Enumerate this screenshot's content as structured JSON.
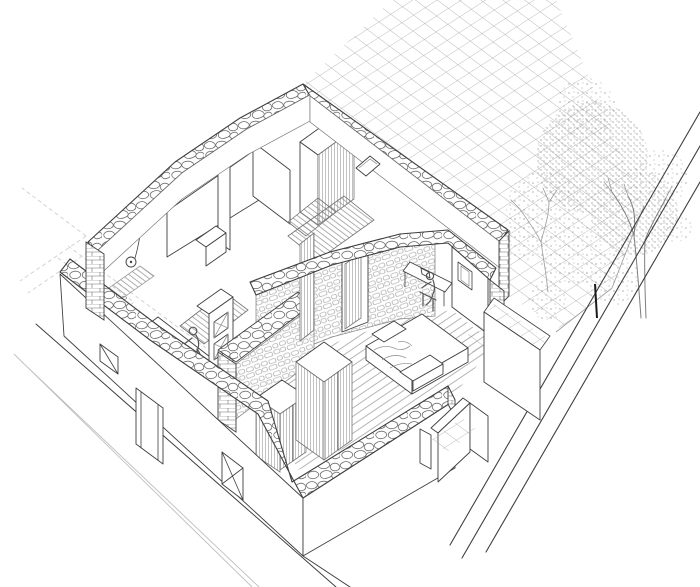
{
  "scene": {
    "type": "architectural axonometric cutaway drawing of a stone house",
    "background": "#ffffff",
    "colors": {
      "ink": "#3f3f3f",
      "stone": "#6f6f6f",
      "masonry": "#9a9a9a",
      "hatch": "#a8a8a8",
      "plank": "#9c9c9c",
      "tile": "#9e9e9e",
      "tree": "#8f8f8f",
      "faint": "#cfcfcf",
      "curb": "#bfbfbf",
      "paper": "#ffffff",
      "figure": "#555555"
    },
    "building": {
      "shell": [
        "rubble-stone wall caps (cut plan)",
        "brick cut wall ends",
        "stone masonry interior wall faces"
      ],
      "rooms": [
        "bathroom",
        "rear rooms",
        "stair hall",
        "kitchen",
        "bedroom"
      ],
      "openings": {
        "front_small_window": 1,
        "front_crossed_window": 1,
        "front_door": 1,
        "diamond_window": 1,
        "bedroom_door": 1,
        "desk_window": 1
      },
      "furniture": [
        "kitchen counter",
        "glazed cabinet",
        "two hatched wardrobes",
        "hatched closet",
        "dresser",
        "bed with blanket and pillow",
        "foot bench",
        "desk with laptop",
        "chair"
      ],
      "fixtures": [
        "shower head",
        "floor drain",
        "two stair flights"
      ],
      "figures": [
        "person at kitchen counter",
        "person seated at desk"
      ]
    },
    "site": {
      "terrace": "large square-tile paved terrace grid",
      "terrace_steps": 3,
      "tile_landing": 1,
      "tree": "large sketched leafy tree",
      "bare_tree": "small bare branch tree",
      "boundary_wall": "long diagonal boundary wall (3 parallel lines)",
      "gate_post_tick": "small dark gate mark",
      "garden_gate_wall": "L-shaped garden wall",
      "street": "street with double curb lines",
      "dashed_projection_lines": 4
    }
  }
}
